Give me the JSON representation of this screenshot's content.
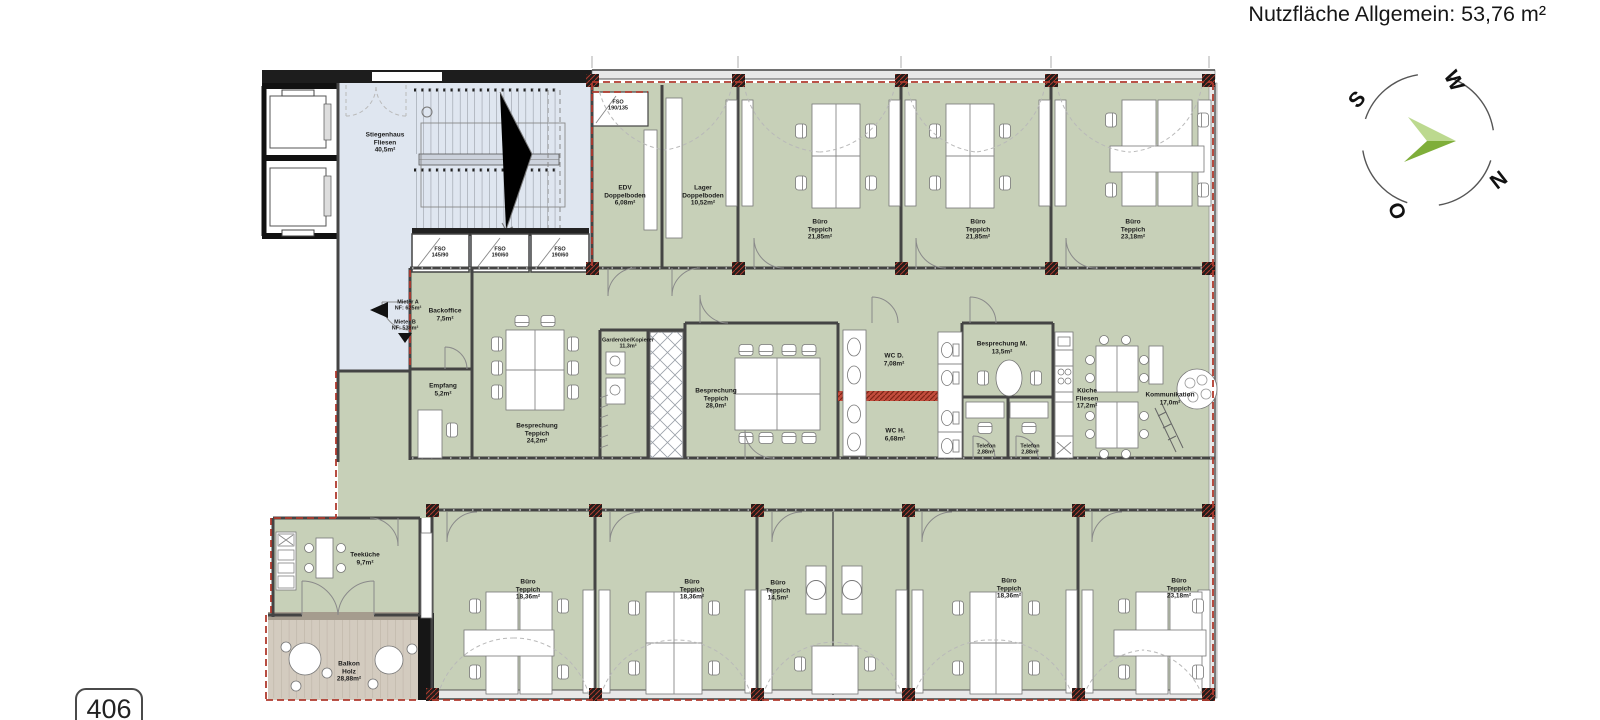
{
  "header": {
    "title": "Nutzfläche Allgemein: 53,76 m²"
  },
  "sheet": {
    "number": "406"
  },
  "compass": {
    "n": "N",
    "o": "O",
    "s": "S",
    "w": "W",
    "arrow_color": "#7fae3a"
  },
  "colors": {
    "office_green": "#c7d0b8",
    "circulation_blue": "#dfe6f0",
    "terrace_wood": "#d3cbbf",
    "boundary_red": "#b03a2e",
    "wall_dark": "#444444"
  },
  "markers": {
    "mieter_a": {
      "label": "Mieter A",
      "value": "NF: 625m²"
    },
    "mieter_b": {
      "label": "Mieter B",
      "value": "NF: 538m²"
    }
  },
  "rooms": {
    "stiegenhaus": {
      "name": "Stiegenhaus",
      "finish": "Fliesen",
      "area": "40,5m²"
    },
    "fso_top": {
      "name": "FSO",
      "size": "190/135"
    },
    "fso_1": {
      "name": "FSO",
      "size": "145/90"
    },
    "fso_2": {
      "name": "FSO",
      "size": "190/60"
    },
    "fso_3": {
      "name": "FSO",
      "size": "190/60"
    },
    "edv": {
      "name": "EDV",
      "finish": "Doppelboden",
      "area": "6,08m²"
    },
    "lager": {
      "name": "Lager",
      "finish": "Doppelboden",
      "area": "10,52m²"
    },
    "buero_top_1": {
      "name": "Büro",
      "finish": "Teppich",
      "area": "21,85m²"
    },
    "buero_top_2": {
      "name": "Büro",
      "finish": "Teppich",
      "area": "21,85m²"
    },
    "buero_top_3": {
      "name": "Büro",
      "finish": "Teppich",
      "area": "23,18m²"
    },
    "backoffice": {
      "name": "Backoffice",
      "area": "7,5m²"
    },
    "empfang": {
      "name": "Empfang",
      "area": "5,2m²"
    },
    "besprechung_l": {
      "name": "Besprechung",
      "finish": "Teppich",
      "area": "24,2m²"
    },
    "garderobe": {
      "name": "Garderobe/Kopierer",
      "finish": "Teppich",
      "area": "11,3m²"
    },
    "besprechung_c": {
      "name": "Besprechung",
      "finish": "Teppich",
      "area": "28,0m²"
    },
    "wc_d": {
      "name": "WC D.",
      "area": "7,08m²"
    },
    "wc_h": {
      "name": "WC H.",
      "area": "6,68m²"
    },
    "besprechung_m": {
      "name": "Besprechung M.",
      "finish": "Teppich",
      "area": "13,5m²"
    },
    "telefon_1": {
      "name": "Telefon",
      "finish": "Teppich",
      "area": "2,88m²"
    },
    "telefon_2": {
      "name": "Telefon",
      "finish": "Teppich",
      "area": "2,88m²"
    },
    "kueche": {
      "name": "Küche",
      "finish": "Fliesen",
      "area": "17,2m²"
    },
    "kommunikation": {
      "name": "Kommunikation",
      "finish": "Teppich",
      "area": "17,0m²"
    },
    "teekueche": {
      "name": "Teeküche",
      "area": "9,7m²"
    },
    "balkon": {
      "name": "Balkon",
      "finish": "Holz",
      "area": "28,88m²"
    },
    "buero_b1": {
      "name": "Büro",
      "finish": "Teppich",
      "area": "18,36m²"
    },
    "buero_b2": {
      "name": "Büro",
      "finish": "Teppich",
      "area": "18,36m²"
    },
    "buero_b3": {
      "name": "Büro",
      "finish": "Teppich",
      "area": "14,5m²"
    },
    "buero_b4": {
      "name": "Büro",
      "finish": "Teppich",
      "area": "18,36m²"
    },
    "buero_b5": {
      "name": "Büro",
      "finish": "Teppich",
      "area": "23,18m²"
    }
  }
}
